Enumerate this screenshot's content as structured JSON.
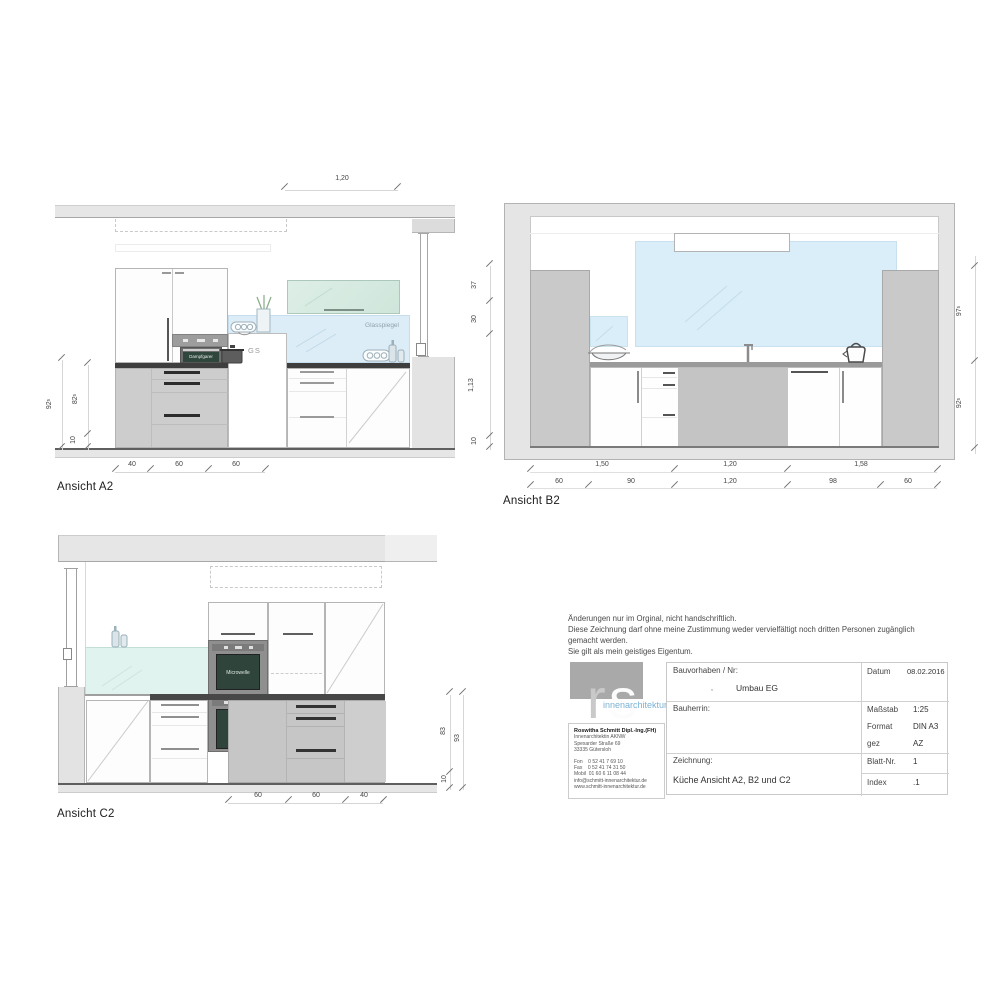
{
  "colors": {
    "glass_blue": "#d9eef8",
    "glass_mint": "#e1f3ee",
    "mirror_green": "#d8ebe2",
    "screen_green": "#2f443a",
    "counter_dark": "#474747",
    "cabinet_gray": "#c9c9c9",
    "wall_gray": "#e6e6e6",
    "logo_gray": "#a9a9a9",
    "logo_blue": "#7ab2d4"
  },
  "a2": {
    "label": "Ansicht A2",
    "top_dim": "1,20",
    "left_dims": [
      {
        "n": "92",
        "s": "5"
      },
      {
        "n": "82",
        "s": "5"
      },
      {
        "n": "10",
        "s": ""
      }
    ],
    "bottom_dims": [
      "40",
      "60",
      "60"
    ],
    "glass_label": "Glasspiegel",
    "appliance_label": "Dampfgarer",
    "gs_label": "GS"
  },
  "b2": {
    "label": "Ansicht B2",
    "left_dims": [
      "37",
      "30",
      "1,13",
      "10"
    ],
    "right_dims": [
      {
        "n": "97",
        "s": "5"
      },
      {
        "n": "92",
        "s": "5"
      }
    ],
    "bottom_dims_row1": [
      "1,50",
      "1,20",
      "1,58"
    ],
    "bottom_dims_row2": [
      "60",
      "90",
      "1,20",
      "98",
      "60"
    ]
  },
  "c2": {
    "label": "Ansicht C2",
    "bottom_dims": [
      "60",
      "60",
      "40"
    ],
    "right_dims": [
      "83",
      "93",
      "10"
    ],
    "microwave_label": "Microwelle"
  },
  "notice": {
    "line1": "Änderungen nur im Orginal, nicht handschriftlich.",
    "line2": "Diese Zeichnung darf ohne meine Zustimmung weder vervielfältigt noch dritten Personen zugänglich",
    "line3": "gemacht werden.",
    "line4": "Sie gilt als mein geistiges Eigentum."
  },
  "titleblock": {
    "logo": {
      "r": "r",
      "s": "s",
      "subtitle": "innenarchitektur"
    },
    "contact": {
      "name": "Roswitha Schmitt Dipl.-Ing.(FH)",
      "line2": "Innenarchitektin AKNW",
      "line3": "Spexarder Straße 69",
      "line4": "33335 Gütersloh",
      "fon": "Fon    0 52 41 7 69 10",
      "fax": "Fax    0 52 41 74 31 50",
      "mobil": "Mobil  01 60 6 11 08 44",
      "email": "info@schmitt-innenarchitektur.de",
      "web": "www.schmitt-innenarchitektur.de"
    },
    "fields": {
      "bauvorhaben_label": "Bauvorhaben / Nr:",
      "project_mark": ",",
      "project": "Umbau EG",
      "bauherrin_label": "Bauherrin:",
      "zeichnung_label": "Zeichnung:",
      "zeichnung_value": "Küche Ansicht A2, B2 und C2",
      "datum_label": "Datum",
      "datum_value": "08.02.2016",
      "massstab_label": "Maßstab",
      "massstab_value": "1:25",
      "format_label": "Format",
      "format_value": "DIN A3",
      "gez_label": "gez",
      "gez_value": "AZ",
      "blatt_label": "Blatt-Nr.",
      "blatt_value": "1",
      "index_label": "Index",
      "index_value": ".1"
    }
  }
}
